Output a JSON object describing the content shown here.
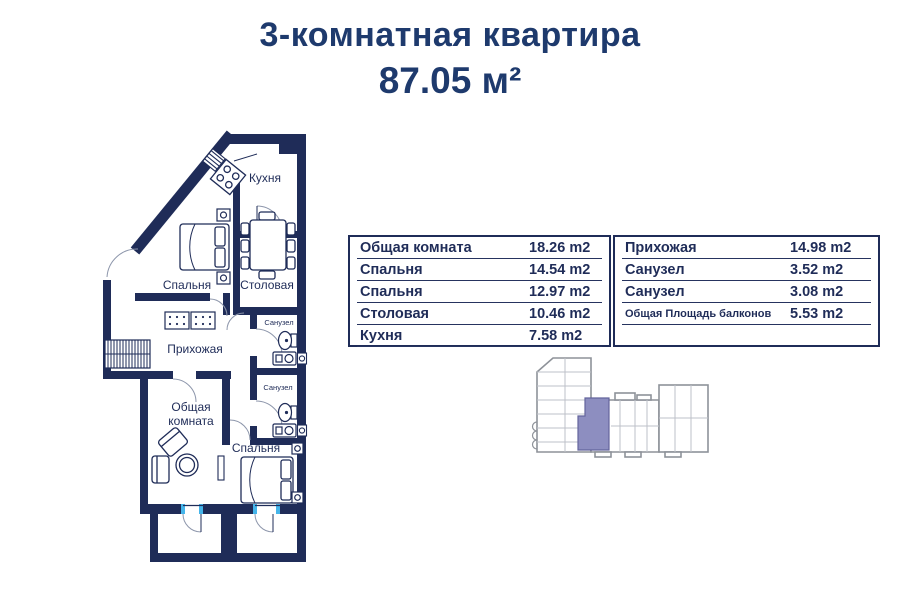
{
  "header": {
    "title": "3-комнатная квартира",
    "area": "87.05 м²"
  },
  "floor_plan": {
    "rooms": {
      "kitchen": "Кухня",
      "bedroom_top": "Спальня",
      "dining": "Столовая",
      "hallway": "Прихожая",
      "bathroom_1": "Санузел",
      "bathroom_2": "Санузел",
      "living_line1": "Общая",
      "living_line2": "комната",
      "bedroom_bottom": "Спальня"
    }
  },
  "area_table_left": {
    "rows": [
      {
        "label": "Общая комната",
        "value": "18.26 m2"
      },
      {
        "label": "Спальня",
        "value": "14.54 m2"
      },
      {
        "label": "Спальня",
        "value": "12.97 m2"
      },
      {
        "label": "Столовая",
        "value": "10.46 m2"
      },
      {
        "label": "Кухня",
        "value": "7.58 m2"
      }
    ]
  },
  "area_table_right": {
    "rows": [
      {
        "label": "Прихожая",
        "value": "14.98 m2"
      },
      {
        "label": "Санузел",
        "value": "3.52 m2"
      },
      {
        "label": "Санузел",
        "value": "3.08 m2"
      },
      {
        "label": "Общая Площадь балконов",
        "value": "5.53 m2"
      }
    ]
  },
  "colors": {
    "navy": "#1f2c58",
    "title_navy": "#1e3a6d",
    "sill_blue": "#45b5ea",
    "map_gray": "#8e9299",
    "map_highlight": "#8d8ec0"
  }
}
